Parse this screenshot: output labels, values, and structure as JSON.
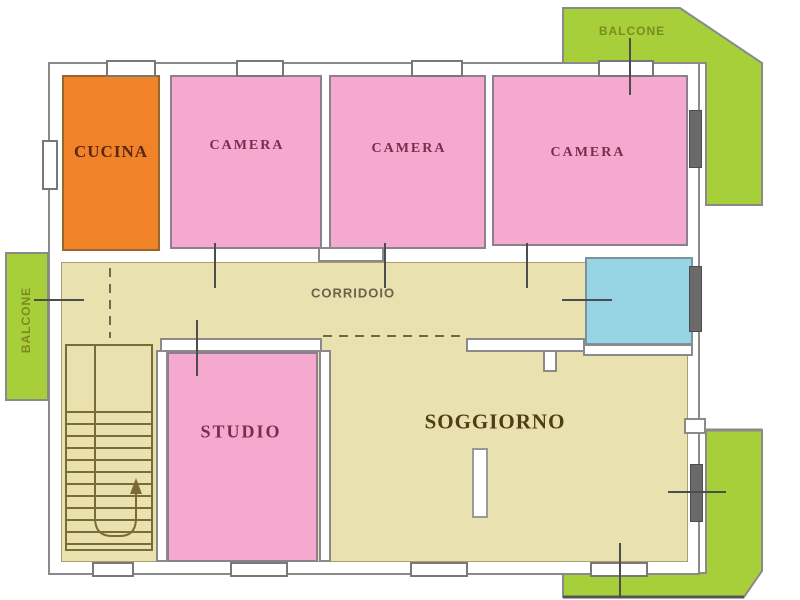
{
  "floor_plan": {
    "labels": {
      "kitchen": "CUCINA",
      "bedroom": "CAMERA",
      "corridor": "CORRIDOIO",
      "study": "STUDIO",
      "living_room": "SOGGIORNO",
      "balcony": "BALCONE"
    },
    "colors": {
      "kitchen_fill": "#F08228",
      "bedroom_fill": "#F6A9CF",
      "corridor_fill": "#EAE1B0",
      "bathroom_fill": "#97D5E5",
      "balcony_fill": "#A6CF3A",
      "wall_line": "#8A8A8A",
      "stair_line": "#7B6C35",
      "bedroom_label": "#7D2A4D",
      "kitchen_label": "#5C2612",
      "living_room_label": "#4F3D15",
      "corridor_label": "#6B6248",
      "balcony_label": "#7C8B1E"
    }
  }
}
